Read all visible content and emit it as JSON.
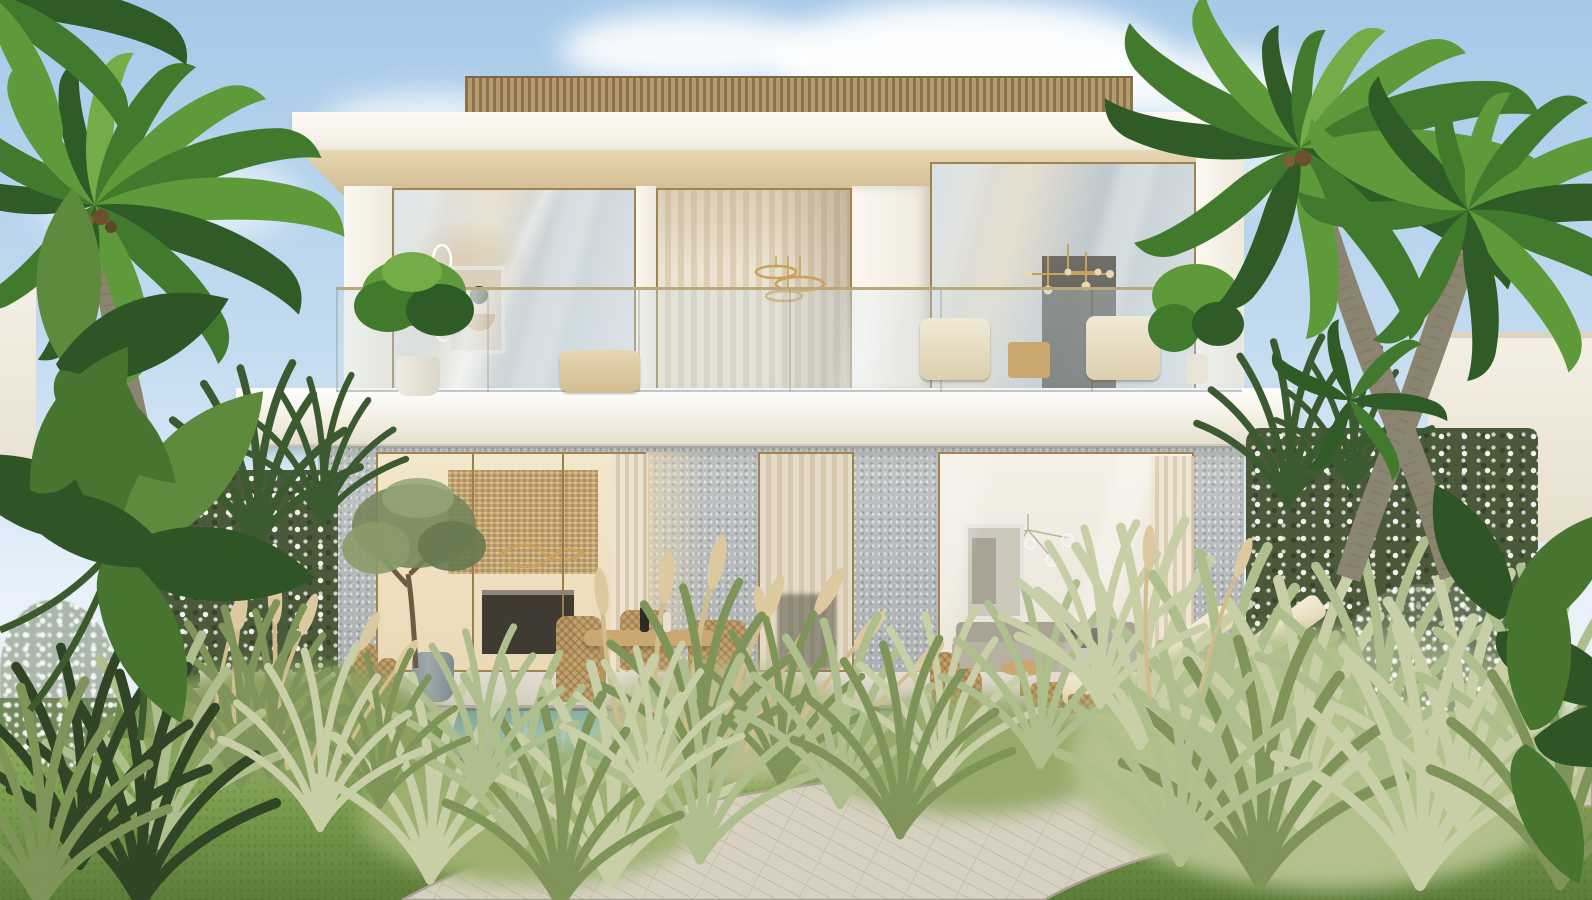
{
  "image": {
    "kind": "photorealistic architectural exterior rendering",
    "subject": "modern two-storey luxury villa with tropical garden, swimming pool and palm trees",
    "setting": "daytime, clear blue sky with soft clouds",
    "visible_text": "none"
  },
  "palette": {
    "sky-top": "#a6c9e8",
    "sky-mid": "#c3dbf0",
    "sky-low": "#e8f1f9",
    "cloud": "#ffffff",
    "villa-white": "#f7f3ea",
    "villa-cream": "#efe9db",
    "soffit": "#e7d7b2",
    "slat": "#b59b6e",
    "slat-dark": "#8a7348",
    "frame-gold": "#a08352",
    "rail-gold": "#bba87a",
    "stone": "#b6babb",
    "interior-warm": "#ead9b6",
    "rattan": "#d8bf92",
    "marble-dark": "#3f3b33",
    "curtain": "#ece4d2",
    "curtain-dark": "#dccfb6",
    "pool": "#9fc5b5",
    "pool-deep": "#88af9f",
    "coping": "#76897f",
    "lawn": "#7da04f",
    "lawn-dark": "#5c7d3a",
    "lawn-light": "#93b061",
    "sage": "#aebe8d",
    "sage-light": "#c8cfa6",
    "straw": "#cfbd8e",
    "palm": "#417a2c",
    "palm-dark": "#2f5b26",
    "palm-light": "#74ac48",
    "trunk": "#8b8470",
    "hedge": "#49593a",
    "hedge-dark": "#36462c",
    "blossom": "#f3f4ef",
    "path": "#d8d1c1",
    "path-line": "#bcb4a1",
    "terrace": "#d2cdbf",
    "wood-furniture": "#c9a971",
    "cushion": "#f2e7cd",
    "wicker": "#c2a06a",
    "pot-ceramic": "#9fa9ad",
    "sofa": "#b7b1a2"
  },
  "scene_objects": {
    "sky": "clear blue sky",
    "clouds": 7,
    "villa": {
      "floors": 2,
      "roof": "flat white fascia with wooden slat screen on top",
      "upper_floor": "full-height glazing, sheer curtains, glass balustrade balcony",
      "balcony_items": [
        "potted-plant",
        "wire-art-sculpture",
        "framed-abstract-art",
        "ring-pendant-lights",
        "sputnik-chandelier",
        "two-armchairs",
        "side-table",
        "monstera-plant"
      ],
      "ground_floor": "grey stone cladding piers with glass sliding walls",
      "kitchen_interior": [
        "rattan screen wall",
        "wave pendant light",
        "dark marble island"
      ],
      "living_interior": [
        "framed abstract art",
        "glass bubble chandelier",
        "beige sofa",
        "sheer curtains"
      ]
    },
    "outdoor": {
      "dining_set": "round wooden table with wicker chairs on terrace",
      "chaise_lounges": 2,
      "ottoman": 1,
      "round_side_table": 1,
      "wicker_vases": 2,
      "blue_ceramic_pot": 1,
      "olive_tree": 1,
      "swimming_pool": "rectangular, turquoise water",
      "stone_terrace": "light travertine deck",
      "path": "curved plank-paved walkway through lawn",
      "lawn": "green grass",
      "planting": [
        "ornamental sage grasses",
        "fountain grass plumes",
        "white flowering hedges",
        "banana foliage",
        "monstera leaves"
      ],
      "palm_trees": {
        "left": 1,
        "right": 2
      },
      "neighbor_buildings": 2
    }
  }
}
